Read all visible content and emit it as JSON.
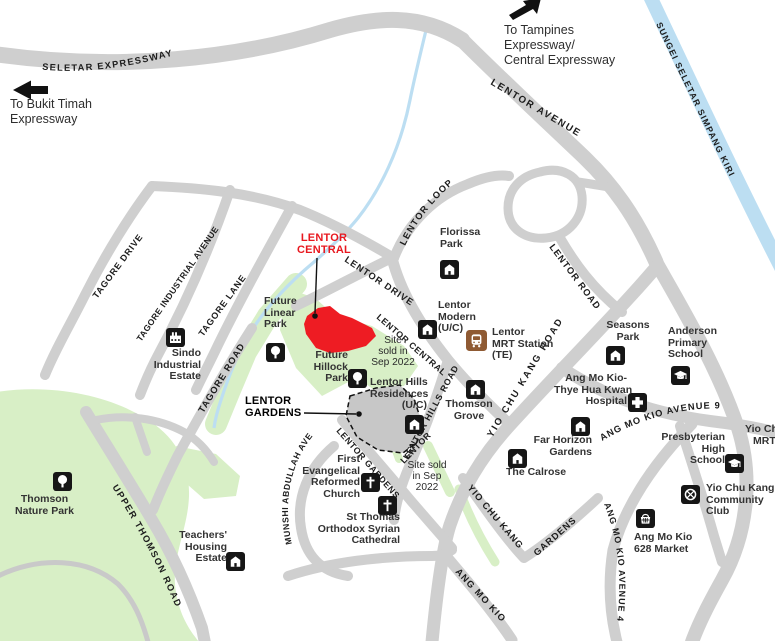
{
  "colors": {
    "road": "#cfcfcf",
    "water": "#bcdef2",
    "park_green": "#d8efc6",
    "site_red": "#ee1c23",
    "site_gray": "#c7c7c7",
    "mrt_brown": "#8f5a33",
    "label_text": "#333333",
    "road_label_text": "#1d1d1d",
    "red_label": "#e8181f"
  },
  "notes": {
    "bukit_timah": [
      "To Bukit Timah",
      "Expressway"
    ],
    "tampines": [
      "To Tampines",
      "Expressway/",
      "Central Expressway"
    ]
  },
  "water": {
    "river": "SUNGEI SELETAR SIMPANG KIRI"
  },
  "roads": {
    "seletar": "SELETAR EXPRESSWAY",
    "lentor_avenue": "LENTOR AVENUE",
    "lentor_loop": "LENTOR LOOP",
    "lentor_drive": "LENTOR DRIVE",
    "lentor_central": "LENTOR CENTRAL",
    "lentor_road": "LENTOR ROAD",
    "tagore_drive": "TAGORE DRIVE",
    "tagore_industrial": "TAGORE INDUSTRIAL AVENUE",
    "tagore_lane": "TAGORE LANE",
    "tagore_road": "TAGORE ROAD",
    "lentor_hills_road": "LENTOR HILLS ROAD",
    "yio_chu_kang_road": "YIO CHU KANG ROAD",
    "amk_ave_9": "ANG MO KIO AVENUE 9",
    "munshi": "MUNSHI ABDULLAH AVE",
    "lentor_gardens_road": "LENTOR GARDENS",
    "lentor_gardens_road_2": "LENTOR",
    "yck_gardens_1": "YIO CHU KANG",
    "yck_gardens_2": "GARDENS",
    "amk_ave_4": "ANG MO KIO AVENUE 4",
    "amk_partial": "ANG MO KIO",
    "upper_thomson": "UPPER THOMSON ROAD"
  },
  "sites": {
    "lentor_central": {
      "lines": [
        "LENTOR",
        "CENTRAL"
      ]
    },
    "lentor_gardens": {
      "lines": [
        "LENTOR",
        "GARDENS"
      ]
    },
    "site_sold_1": {
      "lines": [
        "Site",
        "sold in",
        "Sep 2022"
      ]
    },
    "site_sold_2": {
      "lines": [
        "Site sold",
        "in Sep",
        "2022"
      ]
    }
  },
  "places": {
    "florissa": {
      "lines": [
        "Florissa",
        "Park"
      ],
      "icon": "condo"
    },
    "future_linear": {
      "lines": [
        "Future",
        "Linear",
        "Park"
      ],
      "icon": "tree"
    },
    "sindo": {
      "lines": [
        "Sindo",
        "Industrial",
        "Estate"
      ],
      "icon": "factory"
    },
    "lentor_modern": {
      "lines": [
        "Lentor",
        "Modern",
        "(U/C)"
      ],
      "icon": "condo"
    },
    "lentor_mrt": {
      "lines": [
        "Lentor",
        "MRT Station",
        "(TE)"
      ],
      "icon": "mrt"
    },
    "future_hillock": {
      "lines": [
        "Future",
        "Hillock",
        "Park"
      ],
      "icon": "tree"
    },
    "lentor_hills_res": {
      "lines": [
        "Lentor Hills",
        "Residences",
        "(U/C)"
      ],
      "icon": "condo"
    },
    "thomson_grove": {
      "lines": [
        "Thomson",
        "Grove"
      ],
      "icon": "condo"
    },
    "seasons_park": {
      "lines": [
        "Seasons",
        "Park"
      ],
      "icon": "condo"
    },
    "anderson": {
      "lines": [
        "Anderson",
        "Primary",
        "School"
      ],
      "icon": "school"
    },
    "amk_thk": {
      "lines": [
        "Ang Mo Kio-",
        "Thye Hua Kwan",
        "Hospital"
      ],
      "icon": "hospital"
    },
    "far_horizon": {
      "lines": [
        "Far Horizon",
        "Gardens"
      ],
      "icon": "condo"
    },
    "calrose": {
      "lines": [
        "The Calrose"
      ],
      "icon": "condo"
    },
    "presbyterian": {
      "lines": [
        "Presbyterian",
        "High",
        "School"
      ],
      "icon": "school"
    },
    "yck_cc": {
      "lines": [
        "Yio Chu Kang",
        "Community",
        "Club"
      ],
      "icon": "community-club"
    },
    "amk_628": {
      "lines": [
        "Ang Mo Kio",
        "628 Market"
      ],
      "icon": "market"
    },
    "first_evangelical": {
      "lines": [
        "First",
        "Evangelical",
        "Reformed",
        "Church"
      ],
      "icon": "church"
    },
    "st_thomas": {
      "lines": [
        "St Thomas",
        "Orthodox Syrian",
        "Cathedral"
      ],
      "icon": "church"
    },
    "thomson_nature": {
      "lines": [
        "Thomson",
        "Nature Park"
      ],
      "icon": "tree"
    },
    "teachers": {
      "lines": [
        "Teachers'",
        "Housing",
        "Estate"
      ],
      "icon": "condo"
    },
    "yck_mrt_edge": {
      "lines": [
        "Yio Chu Kang",
        "MRT Station"
      ]
    }
  }
}
